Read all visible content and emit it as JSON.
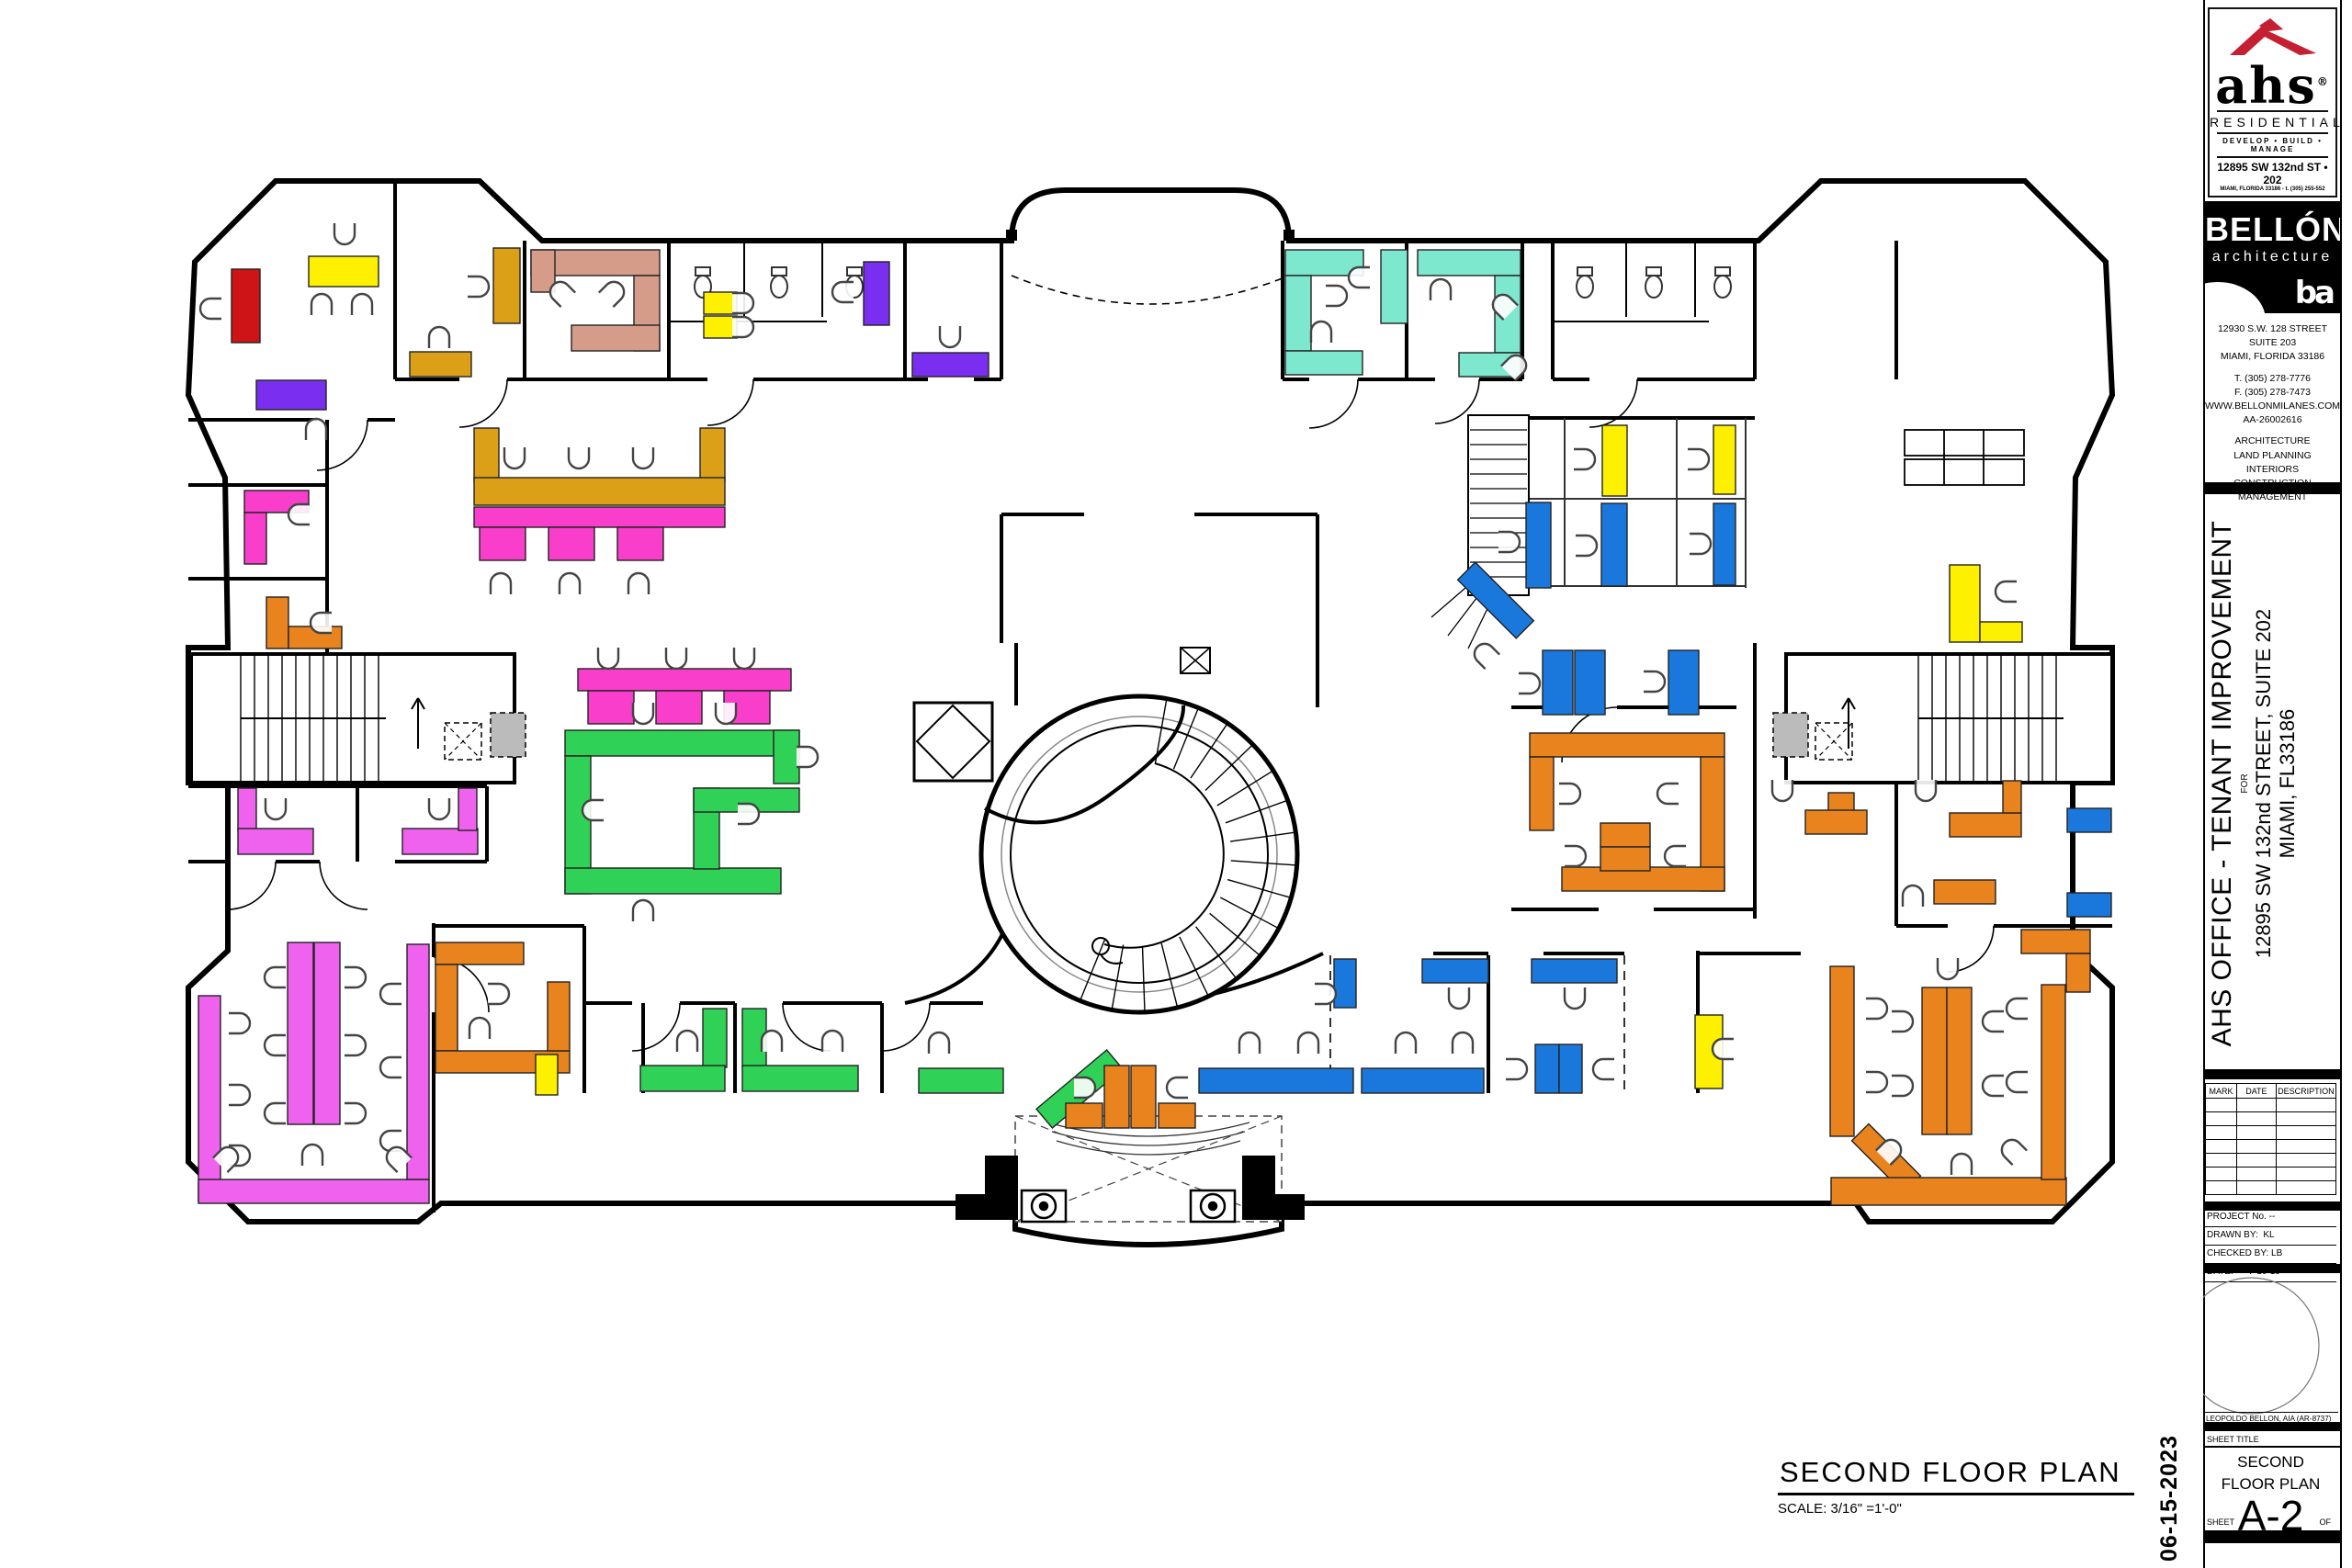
{
  "sheet": {
    "logo": {
      "brand": "ahs",
      "registered": "®",
      "division": "RESIDENTIAL",
      "tagline": "DEVELOP • BUILD • MANAGE",
      "address_line1": "12895 SW 132nd ST • 202",
      "address_line2": "MIAMI, FLORIDA 33186 - t. (305) 255-552"
    },
    "firm": {
      "name": "BELLÓN",
      "subtitle": "architecture",
      "monogram": "ba",
      "address1": "12930 S.W. 128 STREET",
      "address2": "SUITE 203",
      "address3": "MIAMI, FLORIDA  33186",
      "phone": "T. (305) 278-7776",
      "fax": "F. (305) 278-7473",
      "web": "WWW.BELLONMILANES.COM",
      "license": "AA-26002616",
      "svc1": "ARCHITECTURE",
      "svc2": "LAND PLANNING",
      "svc3": "INTERIORS",
      "svc4": "CONSTRUCTION MANAGEMENT"
    },
    "project": {
      "title": "AHS OFFICE - TENANT IMPROVEMENT",
      "for_label": "FOR",
      "address1": "12895 SW 132nd STREET, SUITE 202",
      "address2": "MIAMI, FL33186"
    },
    "revisions": {
      "col1": "MARK",
      "col2": "DATE",
      "col3": "DESCRIPTION",
      "empty_rows": 7
    },
    "info": {
      "project_no": "PROJECT No. --",
      "drawn_label": "DRAWN BY:",
      "drawn_by": "KL",
      "checked_label": "CHECKED BY:",
      "checked_by": "LB",
      "date_label": "DATE:",
      "date": "7-10-19"
    },
    "architect": "LEOPOLDO BELLON, AIA (AR-8737)",
    "sheet_title_label": "SHEET TITLE",
    "sheet_title_line1": "SECOND",
    "sheet_title_line2": "FLOOR PLAN",
    "sheet_number": "A-2",
    "sheet_label": "SHEET",
    "of_label": "OF",
    "print_date": "06-15-2023"
  },
  "drawing": {
    "title": "SECOND FLOOR  PLAN",
    "scale": "SCALE: 3/16\" =1'-0\""
  },
  "plan": {
    "colors": {
      "R": "#cf1418",
      "Y": "#fdf000",
      "P": "#7a2ff0",
      "G": "#dba018",
      "S": "#d69c8a",
      "M": "#f93ecb",
      "V": "#ef62ee",
      "N": "#2fd256",
      "T": "#7ee8cf",
      "B": "#1a78dd",
      "O": "#e8831e"
    },
    "furniture": [
      [
        "R",
        252,
        293,
        31,
        80
      ],
      [
        "Y",
        336,
        279,
        76,
        33
      ],
      [
        "P",
        279,
        414,
        76,
        32
      ],
      [
        "G",
        537,
        270,
        29,
        82
      ],
      [
        "G",
        446,
        383,
        67,
        27
      ],
      [
        "S",
        578,
        272,
        140,
        28
      ],
      [
        "S",
        690,
        300,
        28,
        82
      ],
      [
        "S",
        622,
        354,
        96,
        28
      ],
      [
        "S",
        578,
        272,
        26,
        46
      ],
      [
        "Y",
        766,
        318,
        36,
        24
      ],
      [
        "Y",
        766,
        344,
        36,
        24
      ],
      [
        "P",
        940,
        285,
        28,
        69
      ],
      [
        "P",
        993,
        384,
        83,
        26
      ],
      [
        "T",
        1399,
        272,
        85,
        28
      ],
      [
        "T",
        1399,
        300,
        28,
        82
      ],
      [
        "T",
        1399,
        382,
        84,
        26
      ],
      [
        "T",
        1503,
        272,
        29,
        80
      ],
      [
        "T",
        1543,
        272,
        112,
        28
      ],
      [
        "T",
        1627,
        300,
        28,
        84
      ],
      [
        "T",
        1588,
        384,
        67,
        26
      ],
      [
        "G",
        516,
        466,
        27,
        58
      ],
      [
        "G",
        762,
        466,
        27,
        58
      ],
      [
        "G",
        516,
        520,
        273,
        30
      ],
      [
        "M",
        516,
        552,
        273,
        22
      ],
      [
        "M",
        522,
        574,
        50,
        36
      ],
      [
        "M",
        597,
        574,
        50,
        36
      ],
      [
        "M",
        672,
        574,
        50,
        36
      ],
      [
        "M",
        266,
        534,
        70,
        24
      ],
      [
        "M",
        266,
        558,
        24,
        56
      ],
      [
        "O",
        290,
        650,
        24,
        56
      ],
      [
        "O",
        314,
        682,
        58,
        24
      ],
      [
        "M",
        629,
        728,
        232,
        24
      ],
      [
        "M",
        640,
        752,
        50,
        36
      ],
      [
        "M",
        714,
        752,
        50,
        36
      ],
      [
        "M",
        788,
        752,
        50,
        36
      ],
      [
        "N",
        615,
        795,
        255,
        28
      ],
      [
        "N",
        615,
        823,
        28,
        150
      ],
      [
        "N",
        615,
        945,
        235,
        28
      ],
      [
        "N",
        842,
        795,
        28,
        58
      ],
      [
        "N",
        755,
        858,
        28,
        88
      ],
      [
        "N",
        755,
        858,
        115,
        26
      ],
      [
        "V",
        259,
        858,
        20,
        46
      ],
      [
        "V",
        259,
        902,
        82,
        28
      ],
      [
        "V",
        438,
        902,
        82,
        28
      ],
      [
        "V",
        499,
        858,
        20,
        46
      ],
      [
        "V",
        216,
        1084,
        24,
        224
      ],
      [
        "V",
        216,
        1284,
        251,
        26
      ],
      [
        "V",
        443,
        1028,
        24,
        256
      ],
      [
        "V",
        313,
        1026,
        28,
        198
      ],
      [
        "V",
        342,
        1026,
        28,
        198
      ],
      [
        "O",
        474,
        1026,
        96,
        24
      ],
      [
        "O",
        474,
        1050,
        24,
        94
      ],
      [
        "O",
        474,
        1144,
        146,
        24
      ],
      [
        "O",
        596,
        1069,
        24,
        75
      ],
      [
        "Y",
        583,
        1148,
        24,
        44
      ],
      [
        "N",
        765,
        1098,
        26,
        64
      ],
      [
        "N",
        697,
        1160,
        92,
        28
      ],
      [
        "N",
        808,
        1098,
        26,
        64
      ],
      [
        "N",
        808,
        1160,
        126,
        28
      ],
      [
        "N",
        1000,
        1163,
        92,
        27
      ],
      [
        "N",
        1125,
        1172,
        100,
        27,
        -40
      ],
      [
        "O",
        1202,
        1160,
        27,
        68
      ],
      [
        "O",
        1231,
        1160,
        27,
        68
      ],
      [
        "O",
        1160,
        1201,
        40,
        27
      ],
      [
        "O",
        1261,
        1201,
        40,
        27
      ],
      [
        "B",
        1452,
        1044,
        24,
        53
      ],
      [
        "B",
        1305,
        1163,
        168,
        27
      ],
      [
        "B",
        1482,
        1163,
        133,
        27
      ],
      [
        "B",
        1548,
        1044,
        72,
        26
      ],
      [
        "B",
        1667,
        1044,
        93,
        26
      ],
      [
        "B",
        1671,
        1137,
        26,
        53
      ],
      [
        "B",
        1697,
        1137,
        25,
        53
      ],
      [
        "Y",
        1845,
        1105,
        30,
        80
      ],
      [
        "Y",
        1744,
        463,
        27,
        77
      ],
      [
        "Y",
        1865,
        463,
        24,
        75
      ],
      [
        "B",
        1661,
        547,
        27,
        93
      ],
      [
        "B",
        1743,
        548,
        28,
        90
      ],
      [
        "B",
        1865,
        548,
        24,
        89
      ],
      [
        "B",
        1583,
        640,
        90,
        27,
        45
      ],
      [
        "B",
        1679,
        708,
        33,
        70
      ],
      [
        "B",
        1714,
        708,
        33,
        70
      ],
      [
        "B",
        1816,
        708,
        33,
        70
      ],
      [
        "O",
        1665,
        798,
        212,
        26
      ],
      [
        "O",
        1851,
        824,
        26,
        146
      ],
      [
        "O",
        1665,
        824,
        26,
        80
      ],
      [
        "O",
        1700,
        944,
        177,
        26
      ],
      [
        "O",
        1742,
        896,
        54,
        26
      ],
      [
        "O",
        1742,
        922,
        54,
        26
      ],
      [
        "O",
        1990,
        863,
        28,
        20
      ],
      [
        "O",
        1965,
        882,
        67,
        26
      ],
      [
        "O",
        2122,
        885,
        78,
        26
      ],
      [
        "O",
        2180,
        850,
        20,
        35
      ],
      [
        "O",
        2105,
        958,
        67,
        26
      ],
      [
        "Y",
        2122,
        615,
        33,
        84
      ],
      [
        "Y",
        2155,
        677,
        46,
        22
      ],
      [
        "B",
        2250,
        880,
        48,
        26
      ],
      [
        "B",
        2250,
        972,
        48,
        26
      ],
      [
        "O",
        2200,
        1012,
        75,
        26
      ],
      [
        "O",
        2249,
        1038,
        26,
        42
      ],
      [
        "O",
        1992,
        1052,
        26,
        185
      ],
      [
        "O",
        2013,
        1248,
        80,
        26,
        45
      ],
      [
        "O",
        1993,
        1282,
        256,
        30
      ],
      [
        "O",
        2222,
        1072,
        26,
        212
      ],
      [
        "O",
        2092,
        1075,
        27,
        160
      ],
      [
        "O",
        2119,
        1075,
        27,
        160
      ]
    ],
    "chairs": [
      [
        375,
        252,
        180
      ],
      [
        350,
        334,
        0
      ],
      [
        394,
        334,
        0
      ],
      [
        232,
        336,
        270
      ],
      [
        344,
        470,
        0
      ],
      [
        518,
        312,
        90
      ],
      [
        478,
        370,
        0
      ],
      [
        612,
        320,
        315
      ],
      [
        666,
        320,
        45
      ],
      [
        806,
        330,
        90
      ],
      [
        806,
        356,
        90
      ],
      [
        920,
        318,
        270
      ],
      [
        1034,
        364,
        180
      ],
      [
        1452,
        322,
        90
      ],
      [
        1438,
        364,
        0
      ],
      [
        1482,
        302,
        270
      ],
      [
        1568,
        318,
        0
      ],
      [
        1638,
        334,
        315
      ],
      [
        1648,
        400,
        45
      ],
      [
        560,
        496,
        180
      ],
      [
        630,
        496,
        180
      ],
      [
        700,
        496,
        180
      ],
      [
        545,
        638,
        0
      ],
      [
        620,
        638,
        0
      ],
      [
        695,
        638,
        0
      ],
      [
        662,
        714,
        180
      ],
      [
        736,
        714,
        180
      ],
      [
        810,
        714,
        180
      ],
      [
        328,
        560,
        270
      ],
      [
        352,
        678,
        270
      ],
      [
        700,
        774,
        180
      ],
      [
        790,
        774,
        180
      ],
      [
        648,
        882,
        270
      ],
      [
        700,
        994,
        0
      ],
      [
        812,
        886,
        90
      ],
      [
        876,
        824,
        90
      ],
      [
        300,
        878,
        180
      ],
      [
        478,
        878,
        180
      ],
      [
        258,
        1114,
        90
      ],
      [
        258,
        1192,
        90
      ],
      [
        258,
        1258,
        90
      ],
      [
        302,
        1064,
        270
      ],
      [
        302,
        1138,
        270
      ],
      [
        302,
        1212,
        270
      ],
      [
        384,
        1064,
        90
      ],
      [
        384,
        1138,
        90
      ],
      [
        384,
        1212,
        90
      ],
      [
        428,
        1082,
        270
      ],
      [
        428,
        1162,
        270
      ],
      [
        428,
        1242,
        270
      ],
      [
        246,
        1262,
        45
      ],
      [
        434,
        1262,
        315
      ],
      [
        340,
        1260,
        0
      ],
      [
        540,
        1082,
        90
      ],
      [
        522,
        1122,
        0
      ],
      [
        748,
        1136,
        0
      ],
      [
        840,
        1136,
        0
      ],
      [
        906,
        1136,
        0
      ],
      [
        1022,
        1138,
        0
      ],
      [
        1178,
        1184,
        90
      ],
      [
        1284,
        1184,
        270
      ],
      [
        1360,
        1138,
        0
      ],
      [
        1424,
        1138,
        0
      ],
      [
        1530,
        1138,
        0
      ],
      [
        1592,
        1138,
        0
      ],
      [
        1440,
        1082,
        90
      ],
      [
        1588,
        1084,
        180
      ],
      [
        1714,
        1084,
        180
      ],
      [
        1648,
        1164,
        90
      ],
      [
        1748,
        1164,
        270
      ],
      [
        1878,
        1142,
        270
      ],
      [
        1722,
        500,
        90
      ],
      [
        1846,
        500,
        90
      ],
      [
        1640,
        590,
        90
      ],
      [
        1724,
        594,
        90
      ],
      [
        1848,
        592,
        90
      ],
      [
        1662,
        744,
        90
      ],
      [
        1798,
        742,
        90
      ],
      [
        1618,
        714,
        315
      ],
      [
        1706,
        864,
        90
      ],
      [
        1818,
        864,
        270
      ],
      [
        1712,
        932,
        90
      ],
      [
        1826,
        932,
        270
      ],
      [
        1940,
        858,
        180
      ],
      [
        2096,
        858,
        180
      ],
      [
        2082,
        978,
        0
      ],
      [
        2186,
        644,
        270
      ],
      [
        2040,
        1098,
        90
      ],
      [
        2040,
        1178,
        90
      ],
      [
        2056,
        1254,
        45
      ],
      [
        2198,
        1098,
        270
      ],
      [
        2198,
        1178,
        270
      ],
      [
        2192,
        1254,
        315
      ],
      [
        2068,
        1112,
        90
      ],
      [
        2068,
        1182,
        90
      ],
      [
        2172,
        1112,
        270
      ],
      [
        2172,
        1182,
        270
      ],
      [
        2120,
        1052,
        180
      ],
      [
        2135,
        1270,
        0
      ]
    ]
  }
}
